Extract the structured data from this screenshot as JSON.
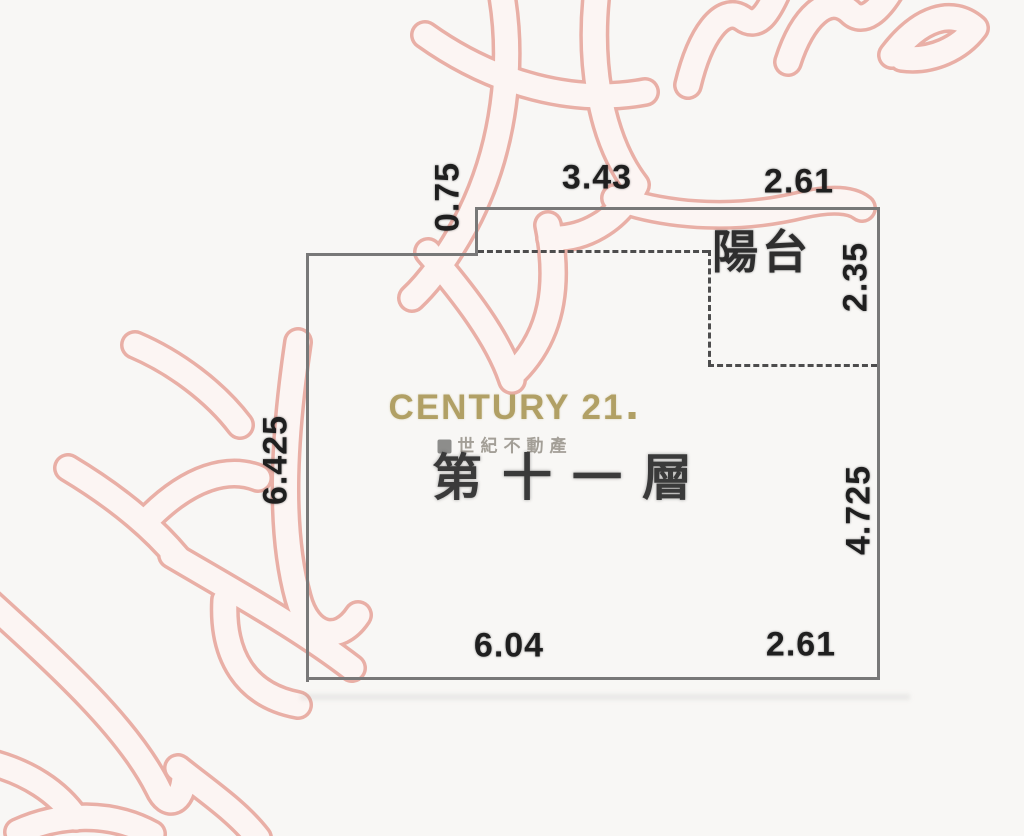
{
  "brand": {
    "name": "CENTURY 21",
    "subtitle": "世紀不動產"
  },
  "floor_label": "第十一層",
  "room": {
    "balcony_label": "陽台"
  },
  "dimensions": {
    "step_left": "0.75",
    "top_main": "3.43",
    "top_balcony": "2.61",
    "balcony_right": "2.35",
    "left_side": "6.425",
    "right_side": "4.725",
    "bottom_main": "6.04",
    "bottom_balcony": "2.61"
  },
  "colors": {
    "brand_gold": "#b1a065",
    "watermark_pink": "#e9afa6",
    "wall_gray": "#787878",
    "dimension_text": "#1f1f1f",
    "background": "#f8f7f5"
  }
}
